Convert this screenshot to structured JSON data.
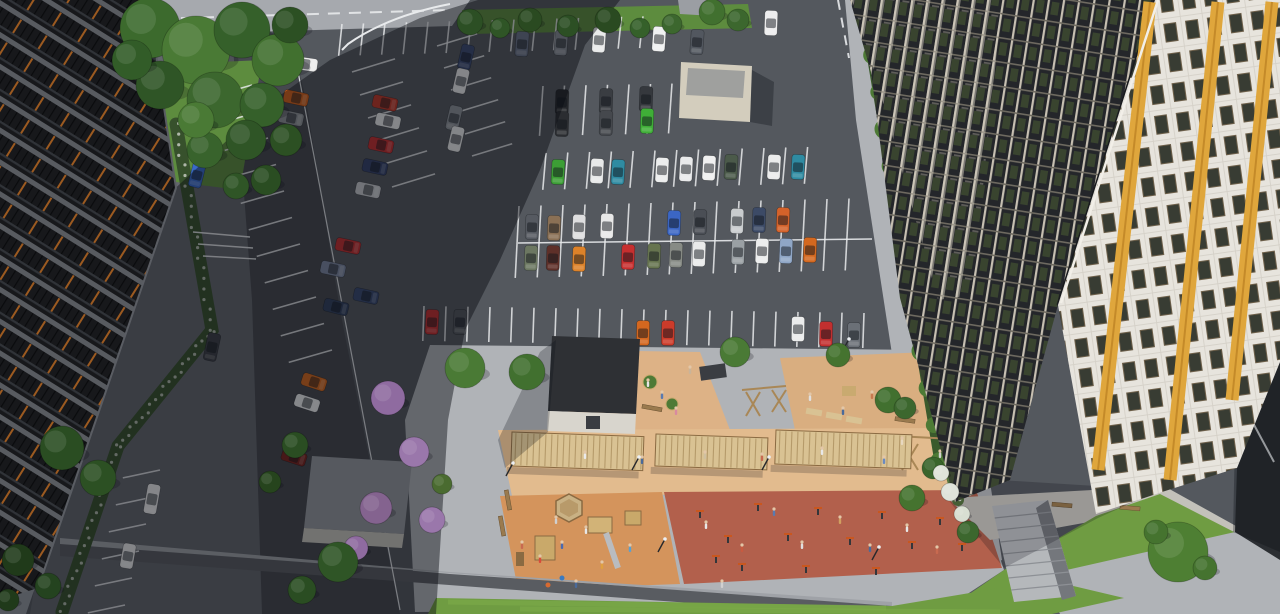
{
  "meta": {
    "title": "Aerial 3D render of residential complex courtyard with parking lot and playground",
    "width": 1280,
    "height": 614
  },
  "palette": {
    "asphalt": "#54585e",
    "asphaltDark": "#33363b",
    "plaza": "#a6a9ae",
    "cobble": "#b0b3b7",
    "cobbleShad": "#63666c",
    "walk": "#c3c1ba",
    "roadLeft": "#45484e",
    "tanA": "#ddb286",
    "tanB": "#d9ae80",
    "pergStrip": "#e2bb8e",
    "kidsOrange": "#d4945c",
    "terra": "#b2604c",
    "wood": "#d9c293",
    "woodDark": "#b59a6a",
    "woodPost": "#8a6a42",
    "grass": "#6f9c42",
    "grassLight": "#7fae4a",
    "grassDark": "#5d8c3e",
    "bedGreen": "#56773f",
    "hedge": "#4d7a35",
    "line": "#e8eaec",
    "wall": "#595c61",
    "wallTop": "#9fa2a7",
    "bldgDark": "#17181b",
    "bldgBand": "#585b60",
    "bldgOrange": "#9c5a20",
    "gridBase": "#24262a",
    "gridLine": "#c7c0b2",
    "gridLine2": "#6e6a60",
    "gridGreen": "#39442f",
    "white": "#e7e4dd",
    "whiteTile": "#d5d1c8",
    "winDark": "#383c33",
    "winFrame": "#6e604a",
    "yellow": "#dfa63c",
    "yellowDark": "#b97f22",
    "beige": "#d3cdbd",
    "beigeRoof": "#9fa09e",
    "roofDark": "#2e3034",
    "wallLight": "#d8d5cd",
    "concrete": "#9b9ea3",
    "stairs": "#b5b8bb",
    "skin": "#e3c7a8"
  },
  "scene": {
    "stall_rows": [
      [
        342,
        24,
        21.5,
        -0.55,
        15,
        32,
        96
      ],
      [
        543,
        86,
        21.5,
        -0.4,
        7,
        50,
        94
      ],
      [
        546,
        153,
        21.8,
        -0.5,
        13,
        37,
        95
      ],
      [
        519,
        206,
        22,
        -0.5,
        16,
        72,
        93
      ],
      [
        424,
        306,
        22,
        0.35,
        21,
        35,
        92
      ],
      [
        352,
        72,
        8,
        23,
        6,
        45,
        343
      ],
      [
        437,
        46,
        7,
        22,
        6,
        42,
        343
      ],
      [
        252,
        85,
        8,
        26.5,
        11,
        45,
        164
      ],
      [
        160,
        470,
        -7,
        27,
        6,
        38,
        168
      ]
    ],
    "lane_lines": [
      [
        862,
        2,
        904,
        294,
        2,
        ""
      ],
      [
        518,
        243,
        872,
        239,
        1.5,
        ""
      ],
      [
        118,
        20,
        448,
        10,
        2,
        "12 9"
      ],
      [
        838,
        0,
        849,
        58,
        2,
        "10 8"
      ],
      [
        1238,
        395,
        1274,
        462,
        2,
        ""
      ],
      [
        292,
        40,
        400,
        610,
        1.2,
        ""
      ],
      [
        193,
        232,
        250,
        237,
        1.4,
        ""
      ],
      [
        198,
        244,
        253,
        248,
        1.4,
        ""
      ],
      [
        203,
        256,
        256,
        259,
        1.4,
        ""
      ]
    ],
    "cars": [
      [
        522,
        44,
        94,
        "#6a7487"
      ],
      [
        561,
        43,
        94,
        "#858a92"
      ],
      [
        599,
        40,
        94,
        "#e9eaea"
      ],
      [
        659,
        39,
        94,
        "#f0f1f1"
      ],
      [
        697,
        42,
        94,
        "#52575f"
      ],
      [
        771,
        23,
        92,
        "#ededee"
      ],
      [
        466,
        57,
        103,
        "#3c4c72"
      ],
      [
        461,
        81,
        103,
        "#e9eaea"
      ],
      [
        454,
        118,
        103,
        "#8d9298"
      ],
      [
        456,
        139,
        103,
        "#e8e9e9"
      ],
      [
        562,
        102,
        92,
        "#25272b"
      ],
      [
        562,
        124,
        92,
        "#2b2d31"
      ],
      [
        606,
        101,
        92,
        "#3a3d42"
      ],
      [
        606,
        123,
        92,
        "#45484d"
      ],
      [
        646,
        99,
        92,
        "#35383d"
      ],
      [
        647,
        121,
        92,
        "#3fae37"
      ],
      [
        558,
        172,
        93,
        "#3c9e35"
      ],
      [
        597,
        171,
        93,
        "#e8e9e9"
      ],
      [
        618,
        172,
        93,
        "#2f8ba2"
      ],
      [
        662,
        170,
        93,
        "#eceded"
      ],
      [
        686,
        169,
        93,
        "#e9eaeb"
      ],
      [
        709,
        168,
        93,
        "#f0f0f0"
      ],
      [
        731,
        167,
        93,
        "#4b5a4a"
      ],
      [
        774,
        167,
        93,
        "#ebecec"
      ],
      [
        798,
        167,
        93,
        "#2f8ba2"
      ],
      [
        532,
        227,
        92,
        "#565a61"
      ],
      [
        554,
        228,
        92,
        "#8a7055"
      ],
      [
        579,
        227,
        92,
        "#dededf"
      ],
      [
        607,
        226,
        92,
        "#e8e8e8"
      ],
      [
        674,
        223,
        92,
        "#3b66c4"
      ],
      [
        700,
        222,
        92,
        "#4a4e55"
      ],
      [
        737,
        221,
        92,
        "#c9ccce"
      ],
      [
        759,
        220,
        92,
        "#3c4a66"
      ],
      [
        783,
        220,
        92,
        "#d4622a"
      ],
      [
        531,
        258,
        92,
        "#6c7761"
      ],
      [
        553,
        258,
        92,
        "#5e3029"
      ],
      [
        579,
        259,
        92,
        "#dd8229"
      ],
      [
        628,
        257,
        92,
        "#c62f2f"
      ],
      [
        654,
        256,
        92,
        "#66744f"
      ],
      [
        676,
        255,
        92,
        "#878b85"
      ],
      [
        699,
        254,
        92,
        "#e9eaea"
      ],
      [
        738,
        252,
        92,
        "#9aa0a4"
      ],
      [
        762,
        251,
        92,
        "#eceded"
      ],
      [
        786,
        251,
        92,
        "#8fa6c6"
      ],
      [
        810,
        250,
        92,
        "#d4681f"
      ],
      [
        432,
        322,
        93,
        "#c23030"
      ],
      [
        460,
        322,
        93,
        "#53565c"
      ],
      [
        643,
        333,
        91,
        "#d4671f"
      ],
      [
        668,
        333,
        91,
        "#cc3b2a"
      ],
      [
        798,
        329,
        91,
        "#ebecec"
      ],
      [
        826,
        334,
        91,
        "#c22f2f"
      ],
      [
        854,
        335,
        91,
        "#6b7077"
      ],
      [
        385,
        103,
        12,
        "#c03a28"
      ],
      [
        388,
        121,
        12,
        "#e8e9e9"
      ],
      [
        381,
        145,
        12,
        "#c43030"
      ],
      [
        375,
        167,
        12,
        "#36436a"
      ],
      [
        368,
        190,
        12,
        "#c6c9cc"
      ],
      [
        348,
        246,
        12,
        "#c33131"
      ],
      [
        333,
        269,
        12,
        "#7d88a0"
      ],
      [
        366,
        296,
        12,
        "#3a4a70"
      ],
      [
        336,
        307,
        14,
        "#32415e"
      ],
      [
        296,
        98,
        12,
        "#d2621c"
      ],
      [
        291,
        118,
        12,
        "#8e9296"
      ],
      [
        286,
        136,
        12,
        "#c9cccf"
      ],
      [
        305,
        64,
        8,
        "#ececec"
      ],
      [
        314,
        382,
        18,
        "#d2691f"
      ],
      [
        307,
        403,
        18,
        "#eceded"
      ],
      [
        294,
        457,
        18,
        "#7a241e"
      ],
      [
        197,
        175,
        104,
        "#3a6ac8"
      ],
      [
        133,
        242,
        100,
        "#e8e9ea"
      ],
      [
        212,
        347,
        102,
        "#3c3f45",
        28
      ],
      [
        152,
        499,
        100,
        "#ebecec",
        30
      ],
      [
        128,
        556,
        100,
        "#e9eaea"
      ]
    ],
    "trees": [
      [
        150,
        28,
        30,
        "#3c6a2d"
      ],
      [
        196,
        50,
        34,
        "#4a7a35"
      ],
      [
        242,
        30,
        28,
        "#35602a"
      ],
      [
        278,
        60,
        26,
        "#41702f"
      ],
      [
        160,
        85,
        24,
        "#2f5526"
      ],
      [
        215,
        100,
        28,
        "#3c672e"
      ],
      [
        262,
        105,
        22,
        "#35602a"
      ],
      [
        290,
        25,
        18,
        "#2c5023"
      ],
      [
        132,
        60,
        20,
        "#325c28"
      ],
      [
        246,
        140,
        20,
        "#2f5526"
      ],
      [
        205,
        150,
        18,
        "#38632c"
      ],
      [
        286,
        140,
        16,
        "#2c5023"
      ],
      [
        266,
        180,
        15,
        "#2a4d22"
      ],
      [
        236,
        186,
        13,
        "#2f5526"
      ],
      [
        196,
        120,
        18,
        "#4a7a35"
      ],
      [
        470,
        22,
        13,
        "#2c4f24"
      ],
      [
        500,
        28,
        10,
        "#2f5526"
      ],
      [
        530,
        20,
        12,
        "#2a4a21"
      ],
      [
        568,
        26,
        11,
        "#2c4f24"
      ],
      [
        608,
        20,
        13,
        "#2a4a21"
      ],
      [
        640,
        28,
        10,
        "#35602a"
      ],
      [
        672,
        24,
        10,
        "#3c672e"
      ],
      [
        712,
        12,
        13,
        "#41702f"
      ],
      [
        738,
        20,
        11,
        "#3c672e"
      ],
      [
        388,
        398,
        17,
        "#8f6ba0"
      ],
      [
        414,
        452,
        15,
        "#9a77ab"
      ],
      [
        376,
        508,
        16,
        "#84638f"
      ],
      [
        432,
        520,
        13,
        "#9a77ab"
      ],
      [
        356,
        548,
        12,
        "#8f6ba0"
      ],
      [
        442,
        484,
        10,
        "#4a6b30"
      ],
      [
        62,
        448,
        22,
        "#2a4d22"
      ],
      [
        98,
        478,
        18,
        "#2c5023"
      ],
      [
        295,
        445,
        13,
        "#2a4d22"
      ],
      [
        270,
        482,
        11,
        "#26441d"
      ],
      [
        338,
        562,
        20,
        "#2f5526"
      ],
      [
        302,
        590,
        14,
        "#2a4d22"
      ],
      [
        18,
        560,
        16,
        "#203a1a"
      ],
      [
        48,
        586,
        13,
        "#24431f"
      ],
      [
        8,
        600,
        11,
        "#203a1a"
      ],
      [
        465,
        368,
        20,
        "#4a7a35"
      ],
      [
        527,
        372,
        18,
        "#41702f"
      ],
      [
        735,
        352,
        15,
        "#4a7a35"
      ],
      [
        838,
        355,
        12,
        "#45732f"
      ],
      [
        888,
        400,
        13,
        "#41702f"
      ],
      [
        912,
        498,
        13,
        "#45732f"
      ],
      [
        933,
        468,
        11,
        "#3a652c"
      ],
      [
        905,
        408,
        11,
        "#3c672e"
      ],
      [
        968,
        532,
        11,
        "#3c672e"
      ],
      [
        1178,
        552,
        30,
        "#4e7f33"
      ],
      [
        1156,
        532,
        12,
        "#45732f"
      ],
      [
        1205,
        568,
        12,
        "#45732f"
      ],
      [
        950,
        492,
        9,
        "#dfe3da"
      ],
      [
        962,
        514,
        8,
        "#d8dfd2"
      ],
      [
        941,
        473,
        8,
        "#dfe3da"
      ]
    ],
    "hedge_strip": {
      "x1": 866,
      "y1": 18,
      "x2": 940,
      "y2": 462,
      "n": 13,
      "r": 10
    },
    "flower_strips": [
      {
        "pts": [
          [
            176,
            124
          ],
          [
            212,
            330
          ],
          [
            118,
            446
          ],
          [
            62,
            612
          ]
        ],
        "w": 13,
        "base": "#37512c",
        "dot": "#aeb6a8",
        "n": 62
      },
      {
        "pts": [
          [
            916,
            330
          ],
          [
            958,
            500
          ]
        ],
        "w": 12,
        "base": "#56773f",
        "dot": "#e8ece4",
        "n": 26
      }
    ],
    "people": [
      [
        648,
        384,
        "#e6e6e6"
      ],
      [
        662,
        396,
        "#5a7ab0"
      ],
      [
        690,
        371,
        "#c9b49a"
      ],
      [
        676,
        412,
        "#d88aa0"
      ],
      [
        585,
        456,
        "#eaeaea"
      ],
      [
        642,
        461,
        "#4a6a9a"
      ],
      [
        705,
        456,
        "#d0c0a0"
      ],
      [
        762,
        458,
        "#c86a50"
      ],
      [
        822,
        452,
        "#e8e8e8"
      ],
      [
        884,
        461,
        "#6a8ac0"
      ],
      [
        940,
        455,
        "#d0d0d0"
      ],
      [
        810,
        398,
        "#e0e0e0"
      ],
      [
        843,
        412,
        "#4a6a9a"
      ],
      [
        872,
        396,
        "#c87a50"
      ],
      [
        902,
        442,
        "#e8d8c0"
      ],
      [
        540,
        560,
        "#d84a3a"
      ],
      [
        562,
        546,
        "#4a6ab0"
      ],
      [
        586,
        531,
        "#e8e8e8"
      ],
      [
        602,
        566,
        "#e0a040"
      ],
      [
        630,
        549,
        "#5aa0d0"
      ],
      [
        556,
        521,
        "#d0d0d0"
      ],
      [
        522,
        546,
        "#c86a50"
      ],
      [
        576,
        585,
        "#4a6a9a"
      ],
      [
        706,
        526,
        "#e8e8e8"
      ],
      [
        742,
        549,
        "#c85a40"
      ],
      [
        774,
        513,
        "#5a7ab0"
      ],
      [
        802,
        546,
        "#e0e0e0"
      ],
      [
        840,
        521,
        "#d0a060"
      ],
      [
        870,
        549,
        "#4a6a9a"
      ],
      [
        907,
        529,
        "#e8e8e8"
      ],
      [
        937,
        551,
        "#c86a50"
      ],
      [
        963,
        533,
        "#5a8ac0"
      ],
      [
        722,
        585,
        "#d0d0d0"
      ]
    ],
    "lamps": [
      [
        506,
        476
      ],
      [
        632,
        470
      ],
      [
        658,
        552
      ],
      [
        762,
        470
      ],
      [
        842,
        352
      ],
      [
        942,
        472
      ],
      [
        997,
        422
      ],
      [
        872,
        560
      ]
    ],
    "pergolas": [
      {
        "x": 512,
        "y": 432,
        "w": 132,
        "h": 34,
        "rot": 2
      },
      {
        "x": 656,
        "y": 434,
        "w": 112,
        "h": 32,
        "rot": 2
      },
      {
        "x": 776,
        "y": 430,
        "w": 136,
        "h": 34,
        "rot": 2
      }
    ],
    "benches": [
      [
        530,
        462,
        2
      ],
      [
        600,
        464,
        2
      ],
      [
        665,
        464,
        2
      ],
      [
        730,
        462,
        2
      ],
      [
        795,
        460,
        2
      ],
      [
        860,
        460,
        2
      ],
      [
        652,
        408,
        10
      ],
      [
        905,
        420,
        8
      ],
      [
        1062,
        505,
        5
      ],
      [
        1130,
        508,
        5
      ],
      [
        508,
        500,
        80
      ],
      [
        502,
        526,
        80
      ]
    ],
    "wood_frames": [
      [
        896,
        436,
        990,
        441
      ],
      [
        902,
        444,
        918,
        470
      ],
      [
        918,
        444,
        902,
        470
      ],
      [
        946,
        448,
        962,
        472
      ],
      [
        962,
        448,
        946,
        472
      ],
      [
        742,
        390,
        786,
        386
      ],
      [
        746,
        392,
        760,
        416
      ],
      [
        760,
        392,
        746,
        416
      ],
      [
        772,
        390,
        786,
        412
      ],
      [
        786,
        390,
        772,
        412
      ]
    ],
    "fitness_marks": [
      [
        700,
        515
      ],
      [
        728,
        540
      ],
      [
        758,
        508
      ],
      [
        788,
        538
      ],
      [
        818,
        512
      ],
      [
        850,
        542
      ],
      [
        882,
        516
      ],
      [
        912,
        546
      ],
      [
        940,
        522
      ],
      [
        962,
        548
      ],
      [
        742,
        568
      ],
      [
        806,
        570
      ],
      [
        876,
        572
      ],
      [
        716,
        560
      ]
    ],
    "yellow_stripes": [
      [
        1150,
        2,
        1098,
        470
      ],
      [
        1218,
        2,
        1170,
        480
      ],
      [
        1272,
        2,
        1232,
        400
      ]
    ],
    "grass_stripes": [
      [
        448,
        602,
        886,
        608
      ],
      [
        520,
        609,
        1000,
        612
      ]
    ],
    "stairs_steps": {
      "l1": [
        992,
        506
      ],
      "l2": [
        1014,
        602
      ],
      "r1": [
        1048,
        500
      ],
      "r2": [
        1076,
        596
      ],
      "n": 8
    },
    "shadows": [
      {
        "pts": "478,0 620,0 585,45 540,170 500,260 465,330 448,420 436,614 26,614 168,195 262,108 330,60 420,18",
        "o": 0.45
      },
      {
        "pts": "1238,300 1262,132 1280,130 1280,552 1233,532",
        "o": 0.3
      },
      {
        "pts": "1000,480 1160,490 1098,518 1004,568 950,502",
        "o": 0.22
      },
      {
        "pts": "752,70 774,82 772,126 750,122",
        "o": 0.3
      },
      {
        "pts": "556,340 548,432 505,468 498,440 540,352",
        "o": 0.25
      }
    ]
  }
}
